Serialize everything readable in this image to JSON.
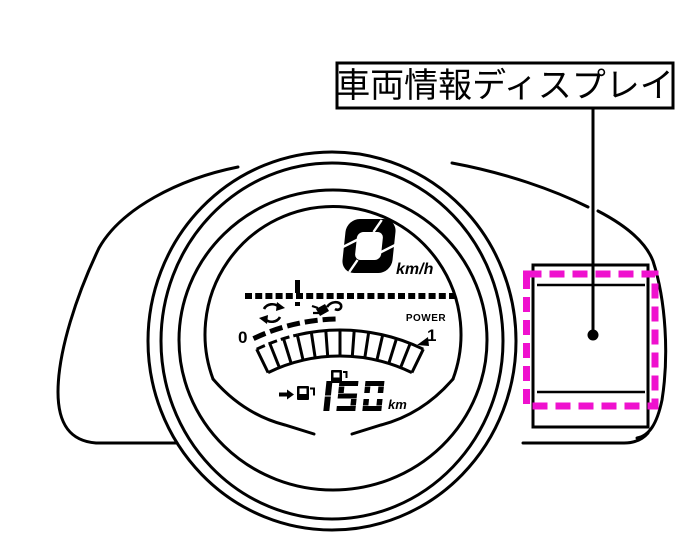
{
  "figure": {
    "title_label": "車両情報ディスプレイ",
    "description": "instrument cluster diagram with vehicle information display highlighted"
  },
  "cluster": {
    "speed": {
      "value": "0",
      "unit": "km/h"
    },
    "trip_bar": {
      "tick_position": "left-third"
    },
    "power_gauge": {
      "min_label": "0",
      "max_label": "1",
      "label": "POWER",
      "segments": 12
    },
    "range": {
      "value": "150",
      "unit": "km"
    },
    "icons": {
      "regen": "regeneration-arrows-icon",
      "charge": "charging-plug-icon",
      "fuel_center": "fuel-pump-icon",
      "fuel_range": "fuel-pump-icon",
      "range_arrow": "right-arrow-icon"
    }
  },
  "highlight": {
    "color": "#EF11CE",
    "style": "dashed-rectangle"
  },
  "colors": {
    "line": "#000000",
    "background": "#FFFFFF"
  }
}
